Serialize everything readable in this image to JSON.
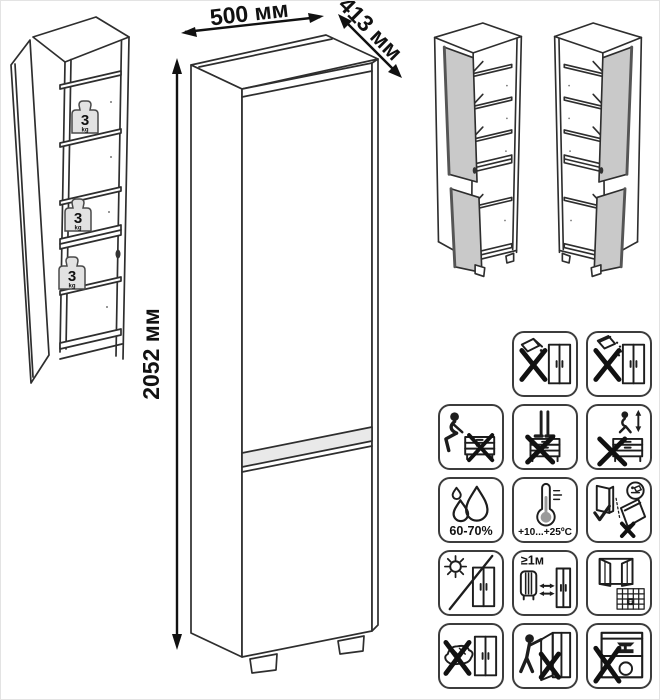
{
  "diagram": {
    "dimensions": {
      "width": "500 мм",
      "depth": "413 мм",
      "height": "2052 мм"
    },
    "shelf_load": {
      "value": "3",
      "unit": "kg"
    },
    "care_labels": {
      "humidity": "60-70%",
      "temperature": "+10...+25ºC",
      "min_distance": "≥1м",
      "calendar_day": "21"
    }
  },
  "icons": [
    "no-wet-cleaning",
    "no-abrasive-powder",
    "no-sitting",
    "no-standing",
    "no-jumping",
    "humidity-range",
    "temperature-range",
    "transport-upright-only",
    "no-direct-sunlight",
    "min-1m-from-heater",
    "ventilate-room",
    "no-abrasive-sponge",
    "no-hanging-on-doors",
    "no-heavy-objects"
  ],
  "colors": {
    "line": "#2e2e2e",
    "door_fill": "#c9c9c9",
    "badge_fill": "#e2e2e2",
    "background": "#ffffff"
  }
}
